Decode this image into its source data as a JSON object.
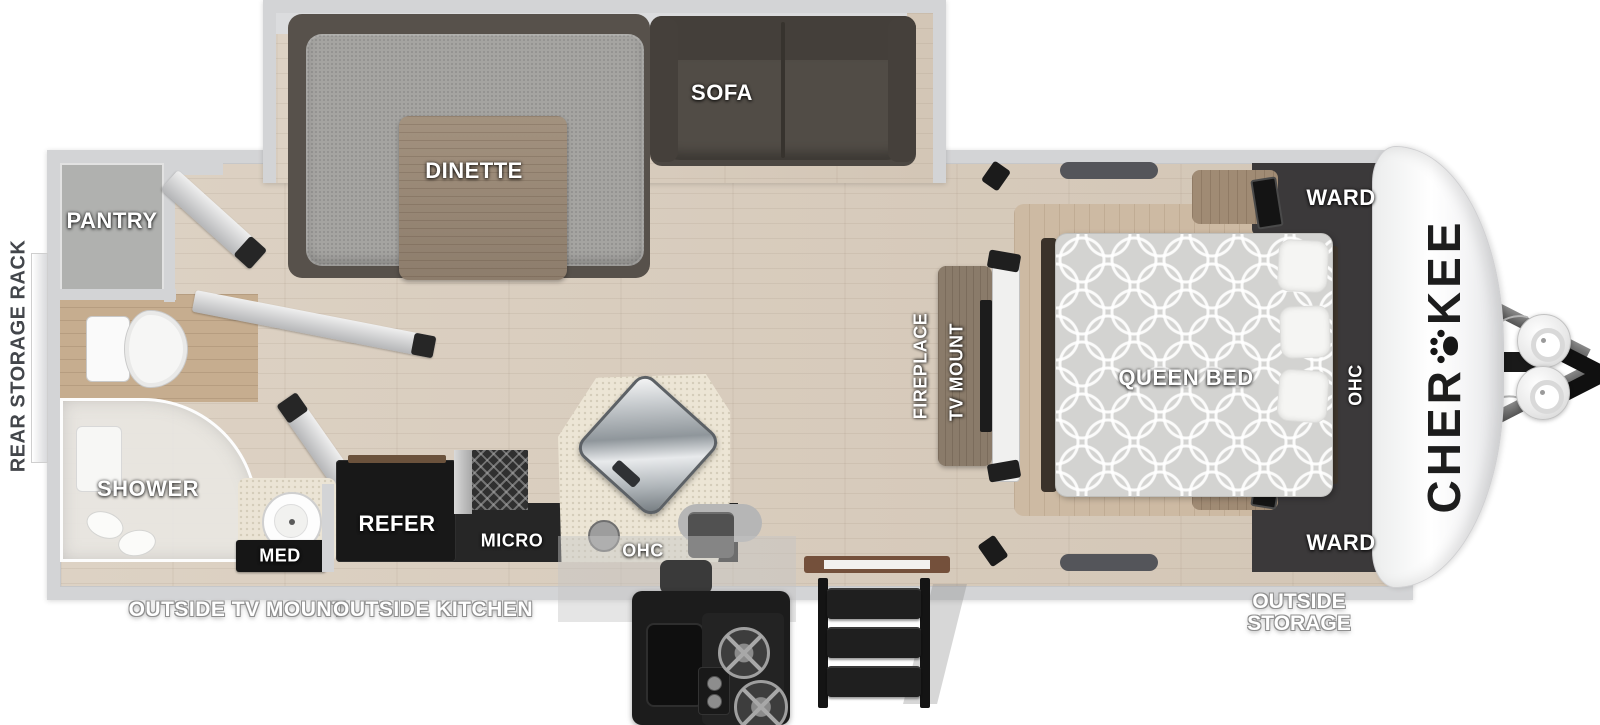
{
  "diagram": {
    "type": "travel trailer floor plan",
    "brand": "Cherokee"
  },
  "front_cap": {
    "logo_part1": "CHER",
    "logo_part2": "KEE",
    "paw_icon": "paw"
  },
  "labels": {
    "rear_storage_rack": "REAR STORAGE RACK",
    "pantry": "PANTRY",
    "dinette": "DINETTE",
    "sofa": "SOFA",
    "shower": "SHOWER",
    "med": "MED",
    "outside_tv_mount": "OUTSIDE TV MOUNT",
    "outside_kitchen": "OUTSIDE KITCHEN",
    "refer": "REFER",
    "micro": "MICRO",
    "kitchen_ohc": "OHC",
    "fireplace": "FIREPLACE",
    "tv_mount": "TV MOUNT",
    "queen_bed": "QUEEN BED",
    "ward_top": "WARD",
    "ward_bottom": "WARD",
    "bedroom_ohc": "OHC",
    "outside_storage_line1": "OUTSIDE",
    "outside_storage_line2": "STORAGE"
  },
  "colors": {
    "background": "#ffffff",
    "wall": "#d3d4d6",
    "floor": "#d8ccbd",
    "charcoal_cabinet": "#3b393a",
    "dark_cabinet": "#262626",
    "sofa": "#4c4742",
    "dinette_cushion": "#a5a4a1",
    "table_wood": "#9b8b7b",
    "bed_platform": "#cdbaa3",
    "label_text": "#ffffff",
    "rear_rack_text": "#43464b",
    "logo_text": "#1d1d1d"
  }
}
